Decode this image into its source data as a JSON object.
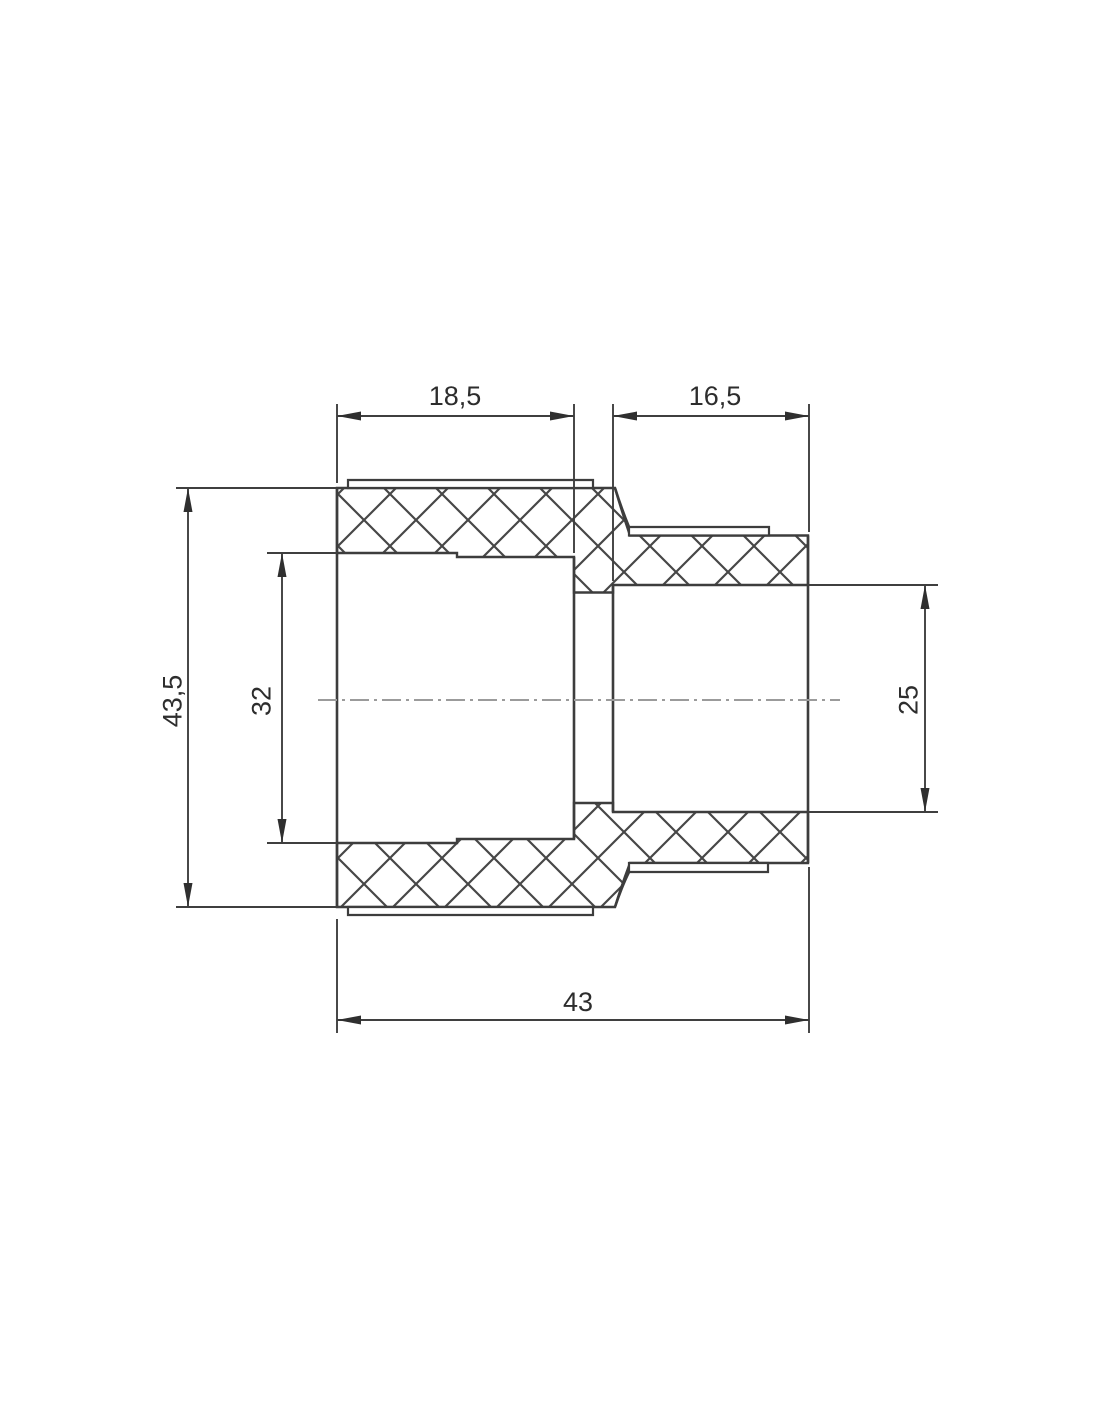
{
  "drawing": {
    "kind": "pipe reducing coupling cross-section",
    "view": "full section with crosshatched walls"
  },
  "labels": {
    "dim_left_socket_depth": "18,5",
    "dim_right_socket_depth": "16,5",
    "dim_outer_diameter": "43,5",
    "dim_left_bore_diameter": "32",
    "dim_right_bore_diameter": "25",
    "dim_overall_length": "43"
  },
  "colors": {
    "line": "#3d3d3d",
    "hatch": "#474747",
    "dimension": "#3f3f3f",
    "text": "#2d2d2d",
    "centerline": "#9b9b9b",
    "background": "#ffffff"
  }
}
